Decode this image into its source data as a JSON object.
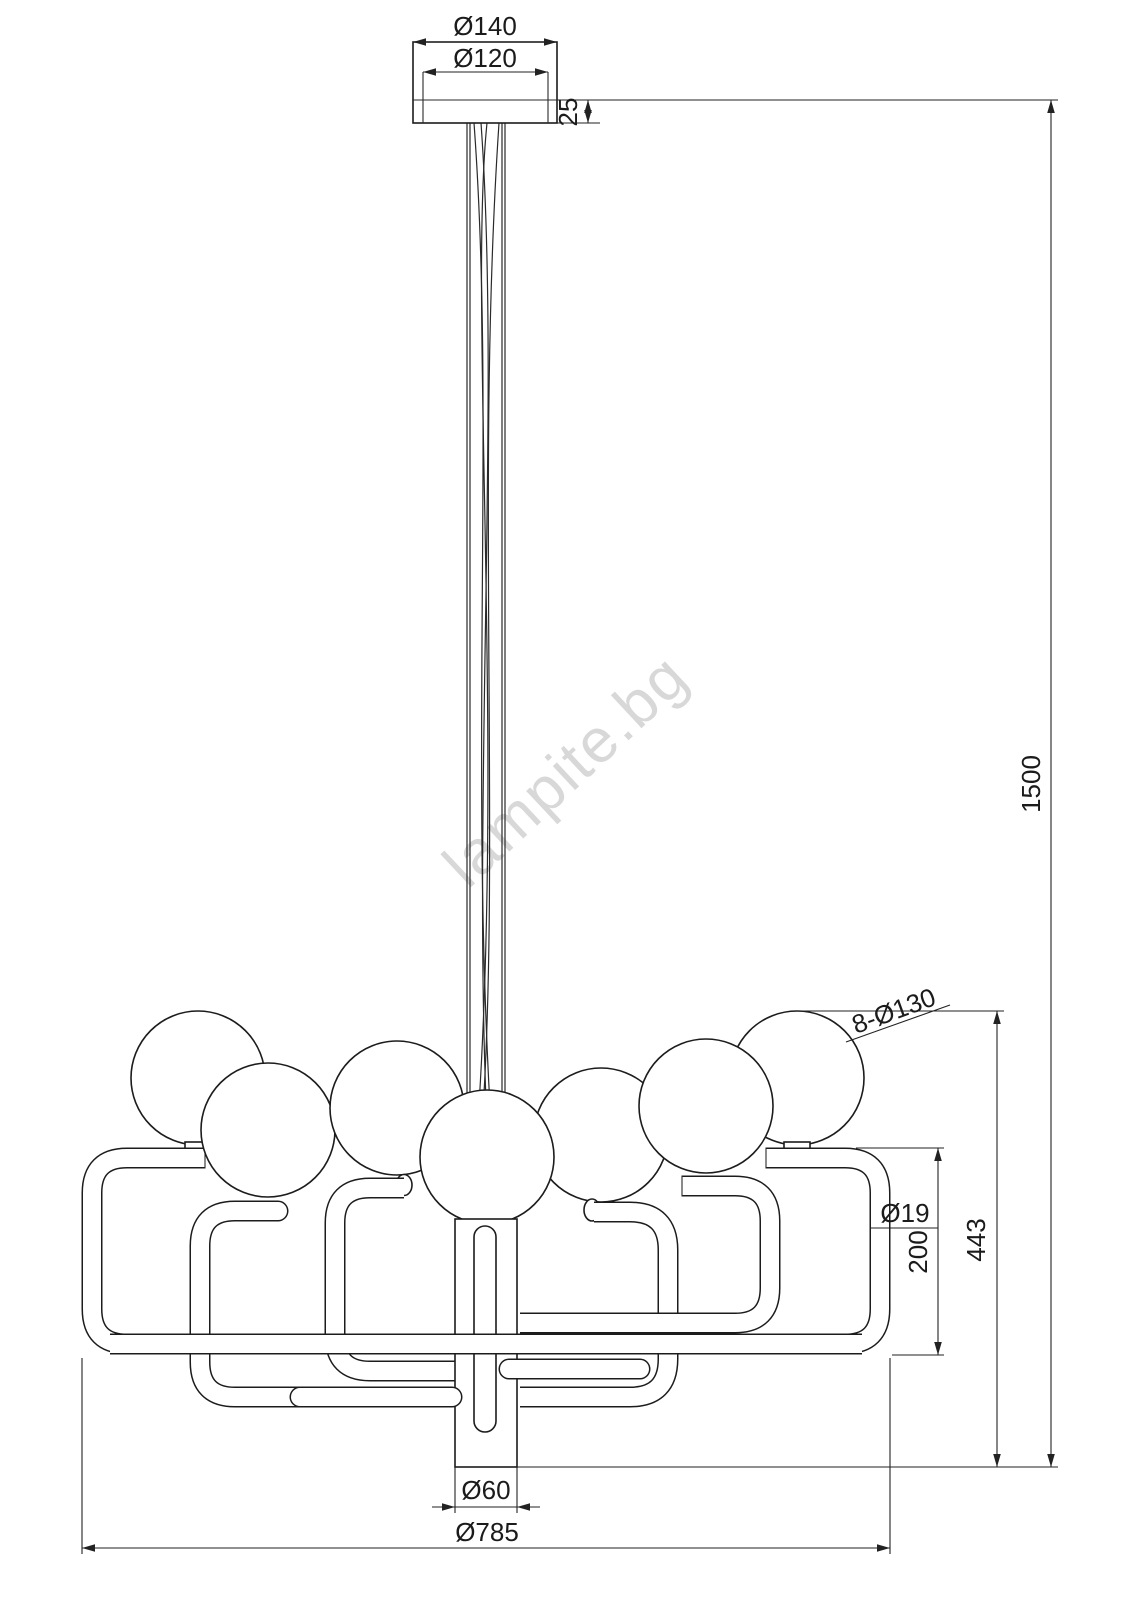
{
  "watermark": "lampite.bg",
  "dims": {
    "canopy_outer_diameter": "Ø140",
    "canopy_inner_diameter": "Ø120",
    "canopy_height": "25",
    "overall_drop": "1500",
    "balls_count_diameter": "8-Ø130",
    "body_height": "443",
    "arm_height": "200",
    "tube_diameter": "Ø19",
    "column_diameter": "Ø60",
    "overall_diameter": "Ø785"
  }
}
